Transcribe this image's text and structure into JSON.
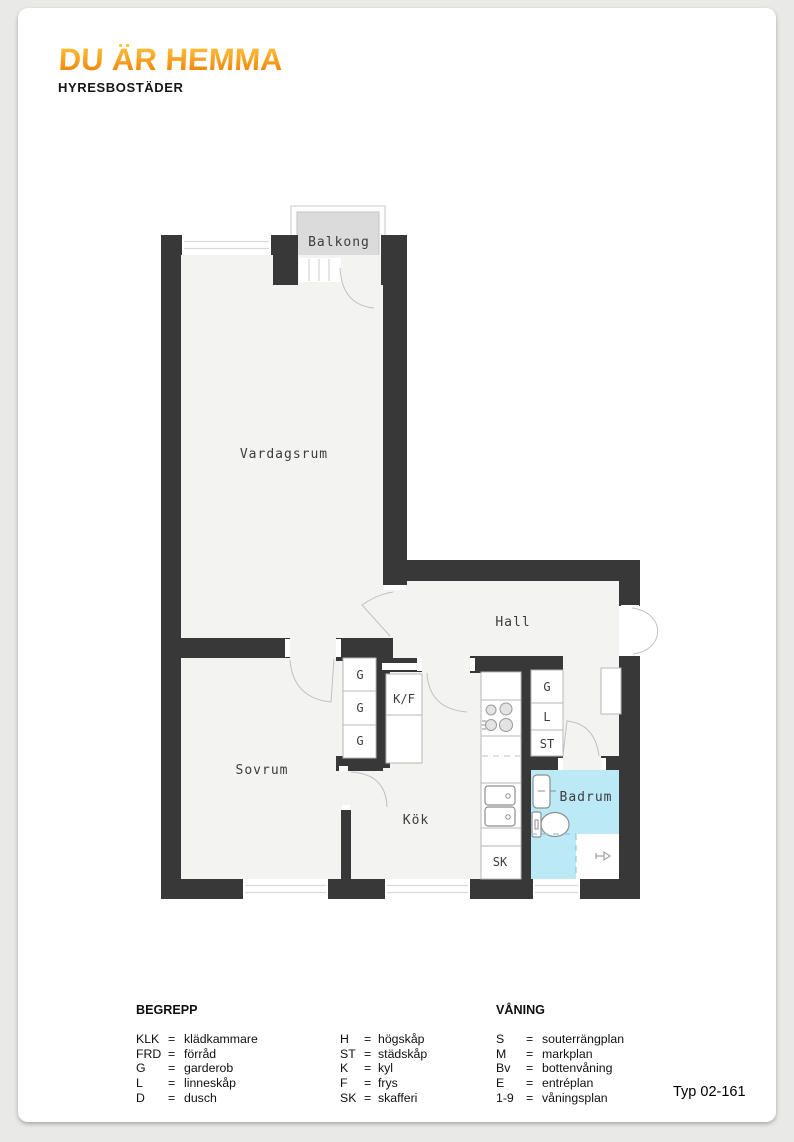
{
  "header": {
    "logo_title": "DU ÄR HEMMA",
    "logo_subtitle": "HYRESBOSTÄDER"
  },
  "plan": {
    "room_labels": {
      "balkong": "Balkong",
      "vardagsrum": "Vardagsrum",
      "hall": "Hall",
      "sovrum": "Sovrum",
      "kok": "Kök",
      "badrum": "Badrum"
    },
    "fixture_labels": {
      "g1": "G",
      "g2": "G",
      "g3": "G",
      "kf": "K/F",
      "g4": "G",
      "l": "L",
      "st": "ST",
      "sk": "SK"
    }
  },
  "legend": {
    "eq": "=",
    "begrepp": {
      "title": "BEGREPP",
      "col1": [
        {
          "abbr": "KLK",
          "term": "klädkammare"
        },
        {
          "abbr": "FRD",
          "term": "förråd"
        },
        {
          "abbr": "G",
          "term": "garderob"
        },
        {
          "abbr": "L",
          "term": "linneskåp"
        },
        {
          "abbr": "D",
          "term": "dusch"
        }
      ],
      "col2": [
        {
          "abbr": "H",
          "term": "högskåp"
        },
        {
          "abbr": "ST",
          "term": "städskåp"
        },
        {
          "abbr": "K",
          "term": "kyl"
        },
        {
          "abbr": "F",
          "term": "frys"
        },
        {
          "abbr": "SK",
          "term": "skafferi"
        }
      ]
    },
    "vaning": {
      "title": "VÅNING",
      "col": [
        {
          "abbr": "S",
          "term": "souterrängplan"
        },
        {
          "abbr": "M",
          "term": "markplan"
        },
        {
          "abbr": "Bv",
          "term": "bottenvåning"
        },
        {
          "abbr": "E",
          "term": "entréplan"
        },
        {
          "abbr": "1-9",
          "term": "våningsplan"
        }
      ]
    },
    "type_label": "Typ 02-161"
  },
  "colors": {
    "wall": "#383838",
    "bathroom_fill": "#bce9f6",
    "balcony_fill": "#dbdbdb",
    "logo_orange_top": "#fdc53e",
    "logo_orange_bottom": "#ee7c00"
  }
}
